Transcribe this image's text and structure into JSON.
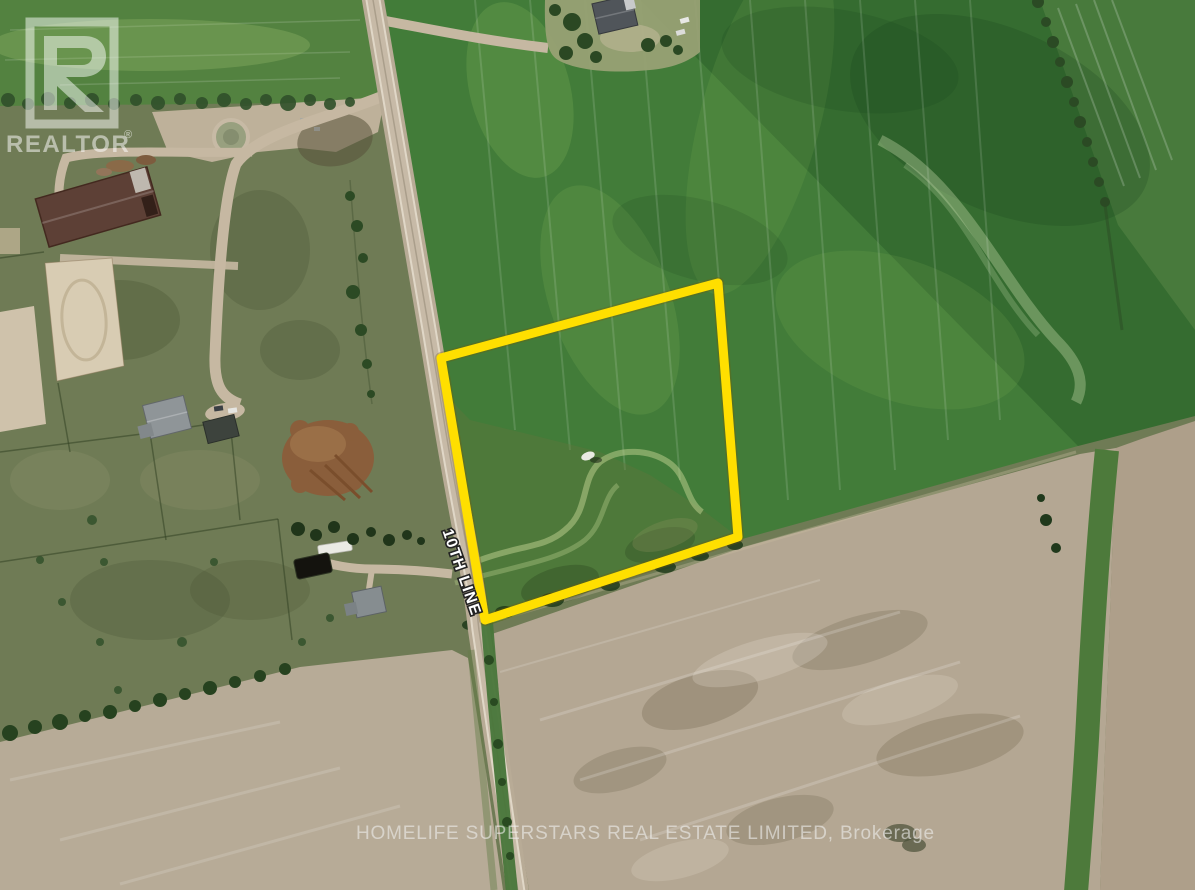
{
  "watermarks": {
    "realtor_logo": {
      "text": "REALTOR",
      "registered": "®"
    },
    "brokerage": "HOMELIFE SUPERSTARS REAL ESTATE LIMITED, Brokerage"
  },
  "road": {
    "label": "10TH LINE"
  },
  "boundary": {
    "color": "#FFDF00",
    "points": "718,283 441,358 485,620 738,537",
    "stroke_width": 9
  },
  "palette": {
    "crop_field_green": "#427C39",
    "pasture_olive": "#6F7B55",
    "plowed_field_tan": "#B4A793",
    "road_surface": "#C7BAA7",
    "barn_roof": "#5D4036",
    "tree_green": "#2B4823",
    "boundary_yellow": "#FFDF00",
    "watermark_white": "rgba(255,255,255,0.5)"
  }
}
